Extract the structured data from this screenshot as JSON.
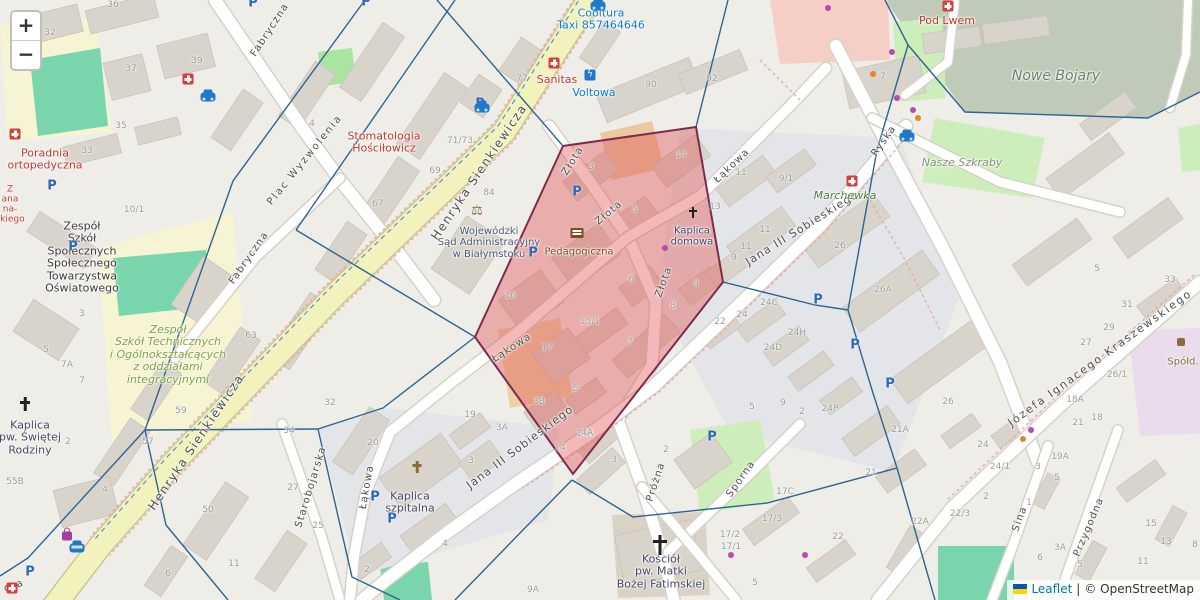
{
  "zoom_control": {
    "zoom_in_label": "+",
    "zoom_out_label": "−"
  },
  "attribution": {
    "leaflet_label": "Leaflet",
    "separator": "|",
    "copyright": "© OpenStreetMap",
    "flag_top_color": "#0057b7",
    "flag_bottom_color": "#ffd500"
  },
  "colors": {
    "highlight_fill": "#e05050",
    "highlight_stroke": "#7b2c4e",
    "edge_stroke": "#2f6491",
    "road_major": "#f2f2bc",
    "poi_red": "#c0392b",
    "poi_blue": "#0e7bd2",
    "poi_worship": "#474768"
  },
  "map": {
    "street_labels": [
      {
        "t": "Fabryczna",
        "x": 270,
        "y": 30,
        "r": -57
      },
      {
        "t": "Plac Wyzwolenia",
        "x": 305,
        "y": 160,
        "r": -51,
        "ls": 2
      },
      {
        "t": "Fabryczna",
        "x": 249,
        "y": 258,
        "r": -55
      },
      {
        "t": "Henryka Sienkiewicza",
        "x": 479,
        "y": 172,
        "r": -56,
        "fs": 12,
        "ls": 1.5
      },
      {
        "t": "Henryka Sienkiewicza",
        "x": 196,
        "y": 442,
        "r": -56,
        "fs": 12,
        "ls": 1.5
      },
      {
        "t": "Złota",
        "x": 573,
        "y": 161,
        "r": -58
      },
      {
        "t": "Złota",
        "x": 609,
        "y": 213,
        "r": -40
      },
      {
        "t": "Złota",
        "x": 664,
        "y": 282,
        "r": -70
      },
      {
        "t": "Łąkowa",
        "x": 732,
        "y": 166,
        "r": -44
      },
      {
        "t": "Łąkowa",
        "x": 512,
        "y": 348,
        "r": -33
      },
      {
        "t": "Łąkowa",
        "x": 367,
        "y": 487,
        "r": -80
      },
      {
        "t": "Jana III Sobieskiego",
        "x": 802,
        "y": 228,
        "r": -32,
        "fs": 11
      },
      {
        "t": "Jana III Sobieskiego",
        "x": 520,
        "y": 447,
        "r": -37,
        "fs": 11
      },
      {
        "t": "Ryska",
        "x": 884,
        "y": 141,
        "r": -55
      },
      {
        "t": "Starobojarska",
        "x": 311,
        "y": 487,
        "r": -73
      },
      {
        "t": "Próżna",
        "x": 656,
        "y": 482,
        "r": -72
      },
      {
        "t": "Sporna",
        "x": 741,
        "y": 479,
        "r": -55
      },
      {
        "t": "Sina",
        "x": 1020,
        "y": 519,
        "r": -70
      },
      {
        "t": "Przygodna",
        "x": 1089,
        "y": 527,
        "r": -67
      },
      {
        "t": "Józefa Ignacego Kraszewskiego",
        "x": 1100,
        "y": 358,
        "r": -36,
        "fs": 11,
        "ls": 1.8
      },
      {
        "t": "cza",
        "x": 14,
        "y": 586,
        "r": -18
      }
    ],
    "poi_labels": [
      {
        "lines": [
          "Poradnia",
          "ortopedyczna"
        ],
        "x": 45,
        "y": 160,
        "c": "#c0392b",
        "fs": 11
      },
      {
        "lines": [
          "Z",
          "ana",
          "na-",
          "skiego"
        ],
        "x": 10,
        "y": 205,
        "c": "#c0392b",
        "fs": 9
      },
      {
        "lines": [
          "Stomatologia",
          "Hościłowicz"
        ],
        "x": 384,
        "y": 143,
        "c": "#c0392b",
        "fs": 11
      },
      {
        "lines": [
          "Cooltura",
          "Taxi 857464646"
        ],
        "x": 601,
        "y": 20,
        "c": "#0e7bd2",
        "fs": 11
      },
      {
        "lines": [
          "Sanitas"
        ],
        "x": 557,
        "y": 80,
        "c": "#c0392b",
        "fs": 11
      },
      {
        "lines": [
          "Voltowa"
        ],
        "x": 594,
        "y": 93,
        "c": "#0e7bd2",
        "fs": 11
      },
      {
        "lines": [
          "Pod Lwem"
        ],
        "x": 947,
        "y": 21,
        "c": "#c0392b",
        "fs": 11
      },
      {
        "lines": [
          "Nowe Bojary"
        ],
        "x": 1056,
        "y": 77,
        "c": "#707f70",
        "fs": 14,
        "it": 1
      },
      {
        "lines": [
          "Nasze Szkraby"
        ],
        "x": 962,
        "y": 163,
        "c": "#85937f",
        "fs": 11,
        "it": 1
      },
      {
        "lines": [
          "Marchewka"
        ],
        "x": 845,
        "y": 196,
        "c": "#567d3e",
        "fs": 11,
        "it": 1
      },
      {
        "lines": [
          "Wojewódzki",
          "Sąd Administracyjny",
          "w Białymstoku"
        ],
        "x": 489,
        "y": 243,
        "c": "#4a5a71",
        "fs": 10
      },
      {
        "lines": [
          "Pedagogiczna"
        ],
        "x": 579,
        "y": 252,
        "c": "#7b4e21",
        "fs": 10
      },
      {
        "lines": [
          "Kaplica",
          "domowa"
        ],
        "x": 692,
        "y": 237,
        "c": "#474768",
        "fs": 10
      },
      {
        "lines": [
          "Kaplica",
          "szpitalna"
        ],
        "x": 410,
        "y": 503,
        "c": "#474768",
        "fs": 11
      },
      {
        "lines": [
          "Kaplica",
          "pw. Świętej",
          "Rodziny"
        ],
        "x": 30,
        "y": 438,
        "c": "#474768",
        "fs": 11
      },
      {
        "lines": [
          "Kościół",
          "pw. Matki",
          "Bożej Fatimskiej"
        ],
        "x": 661,
        "y": 572,
        "c": "#474768",
        "fs": 11
      },
      {
        "lines": [
          "Zespół",
          "Szkół",
          "Społecznych",
          "Społecznego",
          "Towarzystwa",
          "Oświatowego"
        ],
        "x": 82,
        "y": 258,
        "c": "#3c3c3c",
        "fs": 11
      },
      {
        "lines": [
          "Zespół",
          "Szkół Technicznych",
          "i Ogólnokształcących",
          "z oddziałami",
          "integracyjnymi"
        ],
        "x": 168,
        "y": 355,
        "c": "#7fa33c",
        "fs": 11,
        "it": 1
      },
      {
        "lines": [
          "Spółd."
        ],
        "x": 1183,
        "y": 362,
        "c": "#8a6d3b",
        "fs": 10
      }
    ],
    "house_numbers": [
      [
        "32",
        50,
        33
      ],
      [
        "36",
        113,
        5
      ],
      [
        "37",
        131,
        69
      ],
      [
        "39",
        197,
        61
      ],
      [
        "35",
        121,
        126
      ],
      [
        "33",
        87,
        151
      ],
      [
        "4",
        312,
        124
      ],
      [
        "71/73",
        460,
        141
      ],
      [
        "69",
        435,
        171
      ],
      [
        "67",
        378,
        204
      ],
      [
        "84",
        489,
        193
      ],
      [
        "77",
        522,
        79
      ],
      [
        "90",
        651,
        85
      ],
      [
        "92",
        712,
        79
      ],
      [
        "7",
        883,
        77
      ],
      [
        "10/1",
        134,
        210
      ],
      [
        "3",
        82,
        314
      ],
      [
        "5",
        46,
        350
      ],
      [
        "7A",
        67,
        365
      ],
      [
        "7",
        82,
        381
      ],
      [
        "63",
        251,
        336
      ],
      [
        "59",
        181,
        411
      ],
      [
        "57",
        148,
        442
      ],
      [
        "2",
        68,
        442
      ],
      [
        "55B",
        15,
        482
      ],
      [
        "4",
        105,
        490
      ],
      [
        "50",
        208,
        510
      ],
      [
        "11",
        234,
        564
      ],
      [
        "6",
        168,
        574
      ],
      [
        "3",
        591,
        167
      ],
      [
        "14",
        681,
        155
      ],
      [
        "5",
        635,
        210
      ],
      [
        "6",
        631,
        280
      ],
      [
        "9",
        696,
        284
      ],
      [
        "16",
        510,
        296
      ],
      [
        "15/1",
        590,
        322
      ],
      [
        "17",
        547,
        348
      ],
      [
        "7",
        630,
        343
      ],
      [
        "5",
        576,
        389
      ],
      [
        "3B",
        539,
        402
      ],
      [
        "8",
        673,
        306
      ],
      [
        "14A",
        585,
        434
      ],
      [
        "14",
        560,
        448
      ],
      [
        "11",
        741,
        173
      ],
      [
        "9/1",
        786,
        179
      ],
      [
        "13",
        715,
        207
      ],
      [
        "11",
        765,
        230
      ],
      [
        "11",
        746,
        247
      ],
      [
        "9",
        734,
        258
      ],
      [
        "26",
        840,
        246
      ],
      [
        "26A",
        883,
        290
      ],
      [
        "22",
        720,
        322
      ],
      [
        "24C",
        769,
        303
      ],
      [
        "24",
        742,
        315
      ],
      [
        "24H",
        797,
        333
      ],
      [
        "24D",
        773,
        348
      ],
      [
        "32",
        330,
        403
      ],
      [
        "20",
        373,
        443
      ],
      [
        "19",
        470,
        415
      ],
      [
        "3A",
        502,
        428
      ],
      [
        "3",
        471,
        461
      ],
      [
        "27",
        293,
        488
      ],
      [
        "25",
        318,
        526
      ],
      [
        "34",
        289,
        431
      ],
      [
        "4",
        445,
        544
      ],
      [
        "2",
        367,
        570
      ],
      [
        "9A",
        533,
        590
      ],
      [
        "4A",
        587,
        433
      ],
      [
        "3",
        614,
        460
      ],
      [
        "2",
        666,
        450
      ],
      [
        "5",
        752,
        407
      ],
      [
        "9",
        783,
        403
      ],
      [
        "2",
        802,
        412
      ],
      [
        "24P",
        830,
        409
      ],
      [
        "17C",
        785,
        492
      ],
      [
        "17/3",
        772,
        519
      ],
      [
        "17/2",
        730,
        535
      ],
      [
        "17/1",
        731,
        547
      ],
      [
        "22",
        838,
        537
      ],
      [
        "5",
        755,
        583
      ],
      [
        "26",
        948,
        402
      ],
      [
        "18A",
        1075,
        400
      ],
      [
        "21",
        1078,
        423
      ],
      [
        "19A",
        1060,
        457
      ],
      [
        "24",
        983,
        445
      ],
      [
        "24/1",
        1000,
        467
      ],
      [
        "3",
        1038,
        467
      ],
      [
        "5",
        1057,
        478
      ],
      [
        "2",
        986,
        497
      ],
      [
        "1",
        1029,
        503
      ],
      [
        "22/3",
        960,
        514
      ],
      [
        "22A",
        920,
        522
      ],
      [
        "21A",
        900,
        430
      ],
      [
        "21",
        871,
        473
      ],
      [
        "18",
        1097,
        418
      ],
      [
        "5",
        1097,
        269
      ],
      [
        "33",
        1170,
        280
      ],
      [
        "31",
        1127,
        305
      ],
      [
        "29",
        1109,
        328
      ],
      [
        "27",
        1086,
        343
      ],
      [
        "26/1",
        1117,
        375
      ],
      [
        "15",
        1151,
        524
      ],
      [
        "13",
        1166,
        542
      ],
      [
        "8",
        1195,
        545
      ],
      [
        "11",
        1143,
        562
      ],
      [
        "6",
        1040,
        558
      ],
      [
        "3A",
        1060,
        548
      ],
      [
        "5",
        1080,
        565
      ]
    ],
    "icons": [
      {
        "k": "parking",
        "x": 253,
        "y": 3
      },
      {
        "k": "parking",
        "x": 366,
        "y": 2
      },
      {
        "k": "parking",
        "x": 52,
        "y": 186
      },
      {
        "k": "parking",
        "x": 73,
        "y": 247
      },
      {
        "k": "parking",
        "x": 480,
        "y": 104
      },
      {
        "k": "parking",
        "x": 533,
        "y": 253
      },
      {
        "k": "parking",
        "x": 577,
        "y": 192
      },
      {
        "k": "parking",
        "x": 375,
        "y": 497
      },
      {
        "k": "parking",
        "x": 392,
        "y": 519
      },
      {
        "k": "parking",
        "x": 712,
        "y": 437
      },
      {
        "k": "parking",
        "x": 818,
        "y": 300
      },
      {
        "k": "parking",
        "x": 855,
        "y": 345
      },
      {
        "k": "parking",
        "x": 890,
        "y": 384
      },
      {
        "k": "parking",
        "x": 30,
        "y": 572
      },
      {
        "k": "medkit",
        "x": 188,
        "y": 79
      },
      {
        "k": "medkit",
        "x": 15,
        "y": 134
      },
      {
        "k": "medkit",
        "x": 12,
        "y": 588
      },
      {
        "k": "pharmacy",
        "x": 554,
        "y": 63
      },
      {
        "k": "pharmacy",
        "x": 948,
        "y": 6
      },
      {
        "k": "pharmacy",
        "x": 852,
        "y": 181
      },
      {
        "k": "taxi",
        "x": 598,
        "y": 6
      },
      {
        "k": "taxi",
        "x": 482,
        "y": 108
      },
      {
        "k": "taxi",
        "x": 208,
        "y": 97
      },
      {
        "k": "taxi",
        "x": 907,
        "y": 137
      },
      {
        "k": "bus",
        "x": 77,
        "y": 548
      },
      {
        "k": "charging",
        "x": 590,
        "y": 75
      },
      {
        "k": "library",
        "x": 577,
        "y": 233
      },
      {
        "k": "scales",
        "x": 477,
        "y": 211
      },
      {
        "k": "cross-s",
        "x": 693,
        "y": 212
      },
      {
        "k": "cross-m",
        "x": 25,
        "y": 404
      },
      {
        "k": "cross-l",
        "x": 660,
        "y": 545
      },
      {
        "k": "chapel",
        "x": 417,
        "y": 467
      },
      {
        "k": "shop",
        "x": 1181,
        "y": 342
      },
      {
        "k": "bag",
        "x": 67,
        "y": 536
      },
      {
        "k": "dot-purple",
        "x": 892,
        "y": 52
      },
      {
        "k": "dot-purple",
        "x": 897,
        "y": 98
      },
      {
        "k": "dot-purple",
        "x": 913,
        "y": 110
      },
      {
        "k": "dot-purple",
        "x": 828,
        "y": 8
      },
      {
        "k": "dot-purple",
        "x": 665,
        "y": 248
      },
      {
        "k": "dot-purple",
        "x": 731,
        "y": 555
      },
      {
        "k": "dot-purple",
        "x": 805,
        "y": 555
      },
      {
        "k": "dot-purple",
        "x": 1031,
        "y": 430
      },
      {
        "k": "dot-orange",
        "x": 873,
        "y": 74
      },
      {
        "k": "dot-orange",
        "x": 918,
        "y": 118
      },
      {
        "k": "dot-orange",
        "x": 1023,
        "y": 439
      }
    ],
    "overlay": {
      "red_polygon": [
        [
          563,
          146
        ],
        [
          696,
          127
        ],
        [
          723,
          282
        ],
        [
          573,
          474
        ],
        [
          475,
          337
        ]
      ],
      "blue_edges": [
        [
          [
            365,
            0
          ],
          [
            233,
            181
          ],
          [
            145,
            430
          ]
        ],
        [
          [
            145,
            430
          ],
          [
            28,
            558
          ],
          [
            0,
            576
          ]
        ],
        [
          [
            145,
            430
          ],
          [
            166,
            525
          ],
          [
            228,
            600
          ]
        ],
        [
          [
            455,
            0
          ],
          [
            296,
            230
          ]
        ],
        [
          [
            296,
            230
          ],
          [
            475,
            337
          ]
        ],
        [
          [
            437,
            0
          ],
          [
            563,
            146
          ]
        ],
        [
          [
            728,
            0
          ],
          [
            696,
            127
          ]
        ],
        [
          [
            885,
            0
          ],
          [
            908,
            45
          ],
          [
            965,
            112
          ],
          [
            1148,
            118
          ],
          [
            1200,
            92
          ]
        ],
        [
          [
            723,
            282
          ],
          [
            815,
            305
          ],
          [
            848,
            310
          ]
        ],
        [
          [
            848,
            310
          ],
          [
            877,
            150
          ],
          [
            908,
            45
          ]
        ],
        [
          [
            848,
            310
          ],
          [
            872,
            390
          ],
          [
            897,
            468
          ]
        ],
        [
          [
            572,
            480
          ],
          [
            633,
            517
          ],
          [
            767,
            503
          ],
          [
            897,
            468
          ]
        ],
        [
          [
            897,
            468
          ],
          [
            935,
            600
          ]
        ],
        [
          [
            572,
            480
          ],
          [
            520,
            533
          ],
          [
            455,
            600
          ]
        ],
        [
          [
            145,
            430
          ],
          [
            318,
            429
          ]
        ],
        [
          [
            318,
            429
          ],
          [
            383,
            408
          ],
          [
            475,
            337
          ]
        ],
        [
          [
            318,
            429
          ],
          [
            352,
            577
          ],
          [
            400,
            600
          ]
        ]
      ]
    }
  }
}
